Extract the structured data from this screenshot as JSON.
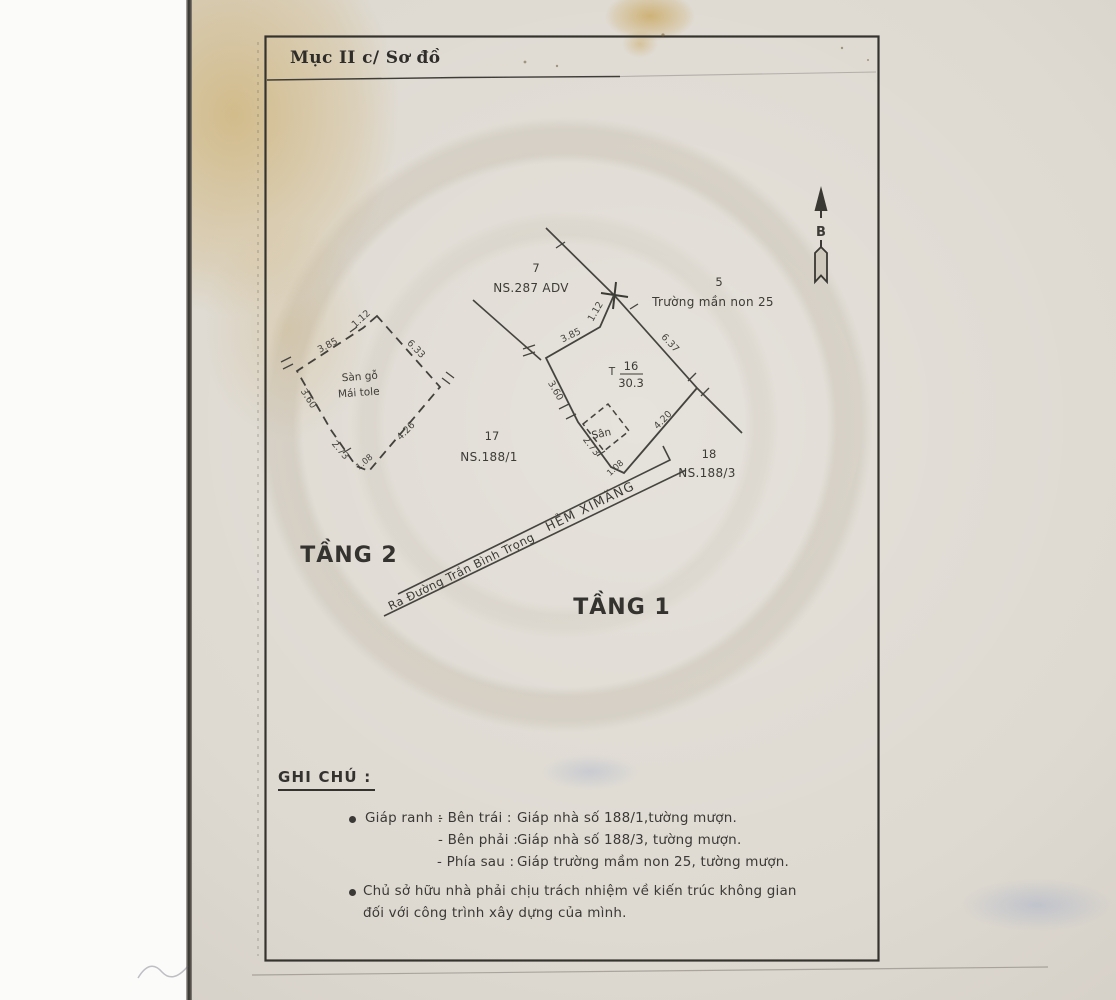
{
  "header": {
    "section_title": "Mục II c/ Sơ đồ"
  },
  "compass": {
    "north_label": "B"
  },
  "diagram": {
    "floor1_label": "TẦNG 1",
    "floor2_label": "TẦNG 2",
    "parcel16": {
      "prefix": "T",
      "number": "16",
      "area": "30.3"
    },
    "yard_label": "Sân",
    "floor2_structure": {
      "line1": "Sàn gỗ",
      "line2": "Mái tole"
    },
    "neighbors": {
      "p7": {
        "number": "7",
        "name": "NS.287 ADV"
      },
      "p5": {
        "number": "5",
        "name": "Trường mần non 25"
      },
      "p17": {
        "number": "17",
        "name": "NS.188/1"
      },
      "p18": {
        "number": "18",
        "name": "NS.188/3"
      }
    },
    "alley": {
      "name": "HẺM XIMĂNG",
      "direction": "Ra Đường Trần Bình Trọng"
    },
    "floor1_dims": {
      "top": "1.12",
      "upper_left": "3.85",
      "upper_right": "6.37",
      "left": "3.60",
      "lower_left": "2.73",
      "bottom": "1.08",
      "lower_right": "4.20"
    },
    "floor2_dims": {
      "top": "1.12",
      "upper_left": "3.85",
      "upper_right": "6.33",
      "left": "3.60",
      "lower_left": "2.73",
      "bottom": "1.08",
      "lower_right": "4.26"
    }
  },
  "notes": {
    "heading": "GHI CHÚ :",
    "boundary_label": "Giáp ranh :",
    "boundary_rows": [
      {
        "side": "- Bên trái :",
        "text": "Giáp nhà số 188/1,tường mượn."
      },
      {
        "side": "- Bên phải :",
        "text": "Giáp nhà số 188/3, tường mượn."
      },
      {
        "side": "- Phía sau :",
        "text": "Giáp trường mầm non 25, tường mượn."
      }
    ],
    "responsibility_line1": "Chủ sở hữu nhà phải chịu trách nhiệm về kiến trúc không gian",
    "responsibility_line2": "đối với công trình xây dựng của mình."
  },
  "colors": {
    "paper": "#dbd6cd",
    "ink": "#3c3a36",
    "stain": "#c9a05a"
  }
}
